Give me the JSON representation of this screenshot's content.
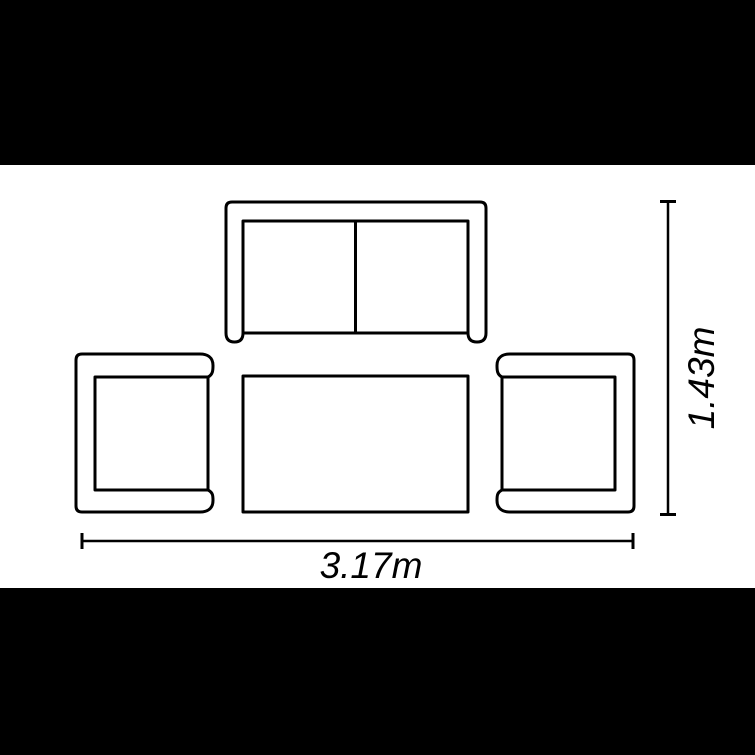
{
  "diagram": {
    "type": "furniture-set-top-view-plan",
    "items": [
      {
        "id": "two-seat-sofa",
        "label": "two-seat sofa"
      },
      {
        "id": "armchair-left",
        "label": "left armchair"
      },
      {
        "id": "coffee-table",
        "label": "coffee table"
      },
      {
        "id": "armchair-right",
        "label": "right armchair"
      }
    ],
    "dimensions": {
      "width_label": "3.17m",
      "height_label": "1.43m"
    }
  },
  "colors": {
    "ink": "#000000",
    "background": "#ffffff",
    "letterbox": "#000000"
  }
}
